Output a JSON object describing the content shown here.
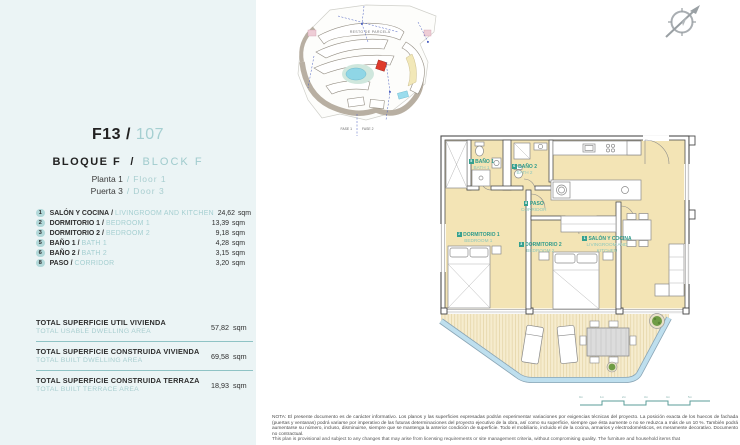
{
  "colors": {
    "panel_bg": "#ebf4f5",
    "accent_teal": "#a5cfd1",
    "badge_teal": "#b2d9da",
    "plan_label_green": "#2f9b8c",
    "floor_cream": "#f3e4b5",
    "highlight_red": "#df3a2c"
  },
  "header": {
    "code": "F13 /",
    "number": "107",
    "block_es": "BLOQUE F",
    "slash": "/",
    "block_en": "BLOCK F",
    "floor_es": "Planta 1",
    "floor_en": "Floor 1",
    "door_es": "Puerta 3",
    "door_en": "Door 3"
  },
  "rooms": [
    {
      "num": "1",
      "name_es": "SALÓN Y COCINA",
      "sep": "/",
      "name_en": "LIVINGROOM AND KITCHEN",
      "area": "24,62",
      "unit": "sqm"
    },
    {
      "num": "2",
      "name_es": "DORMITORIO 1",
      "sep": "/",
      "name_en": "BEDROOM 1",
      "area": "13,39",
      "unit": "sqm"
    },
    {
      "num": "3",
      "name_es": "DORMITORIO 2",
      "sep": "/",
      "name_en": "BEDROOM 2",
      "area": "9,18",
      "unit": "sqm"
    },
    {
      "num": "5",
      "name_es": "BAÑO 1",
      "sep": "/",
      "name_en": "BATH 1",
      "area": "4,28",
      "unit": "sqm"
    },
    {
      "num": "6",
      "name_es": "BAÑO 2",
      "sep": "/",
      "name_en": "BATH 2",
      "area": "3,15",
      "unit": "sqm"
    },
    {
      "num": "8",
      "name_es": "PASO",
      "sep": "/",
      "name_en": "CORRIDOR",
      "area": "3,20",
      "unit": "sqm"
    }
  ],
  "totals": [
    {
      "label_es": "TOTAL SUPERFICIE UTIL VIVIENDA",
      "label_en": "TOTAL USABLE DWELLING AREA",
      "value": "57,82",
      "unit": "sqm"
    },
    {
      "label_es": "TOTAL SUPERFICIE CONSTRUIDA VIVIENDA",
      "label_en": "TOTAL BUILT DWELLING AREA",
      "value": "69,58",
      "unit": "sqm"
    },
    {
      "label_es": "TOTAL SUPERFICIE CONSTRUIDA TERRAZA",
      "label_en": "TOTAL BUILT TERRACE AREA",
      "value": "18,93",
      "unit": "sqm"
    }
  ],
  "site_plan": {
    "resto_label": "RESTO DE PARCELA",
    "fase1": "FASE 1",
    "fase2": "FASE 2"
  },
  "floor_plan": {
    "labels": [
      {
        "num": "5",
        "es": "BAÑO 1",
        "en": "BATH 1"
      },
      {
        "num": "6",
        "es": "BAÑO 2",
        "en": "BATH 2"
      },
      {
        "num": "8",
        "es": "PASO",
        "en": "CORRIDOR"
      },
      {
        "num": "2",
        "es": "DORMITORIO 1",
        "en": "BEDROOM 1"
      },
      {
        "num": "3",
        "es": "DORMITORIO 2",
        "en": "BEDROOM 2"
      },
      {
        "num": "1",
        "es": "SALÓN Y COCINA",
        "en": "LIVINGROOM AND KITCHEN"
      }
    ]
  },
  "scale_bar": {
    "ticks": [
      "0m",
      "1m",
      "2m",
      "3m",
      "4m",
      "5m"
    ]
  },
  "note": {
    "es": "NOTA: El presente documento es de carácter informativo. Los planos y las superficies expresadas podrán experimentar variaciones por exigencias técnicas del proyecto. La posición exacta de los huecos de fachada (puertas y ventanas) podrá variarse por imperativo de las futuras determinaciones del proyecto ejecutivo de la obra, así como su superficie, siempre que ésta aumente o no se reduzca a más de un 10 %. También podrá aumentarse su número, incluso, disminuirse, siempre que se mantenga la anterior condición de superficie. Todo el mobiliario, incluido el de la cocina, armarios y electrodomésticos, es meramente decorativo. Documento no contractual.",
    "en": "This plan is provisional and subject to any changes that may arise from licensing requirements or site management criteria, without compromising quality. The furniture and household items that"
  }
}
